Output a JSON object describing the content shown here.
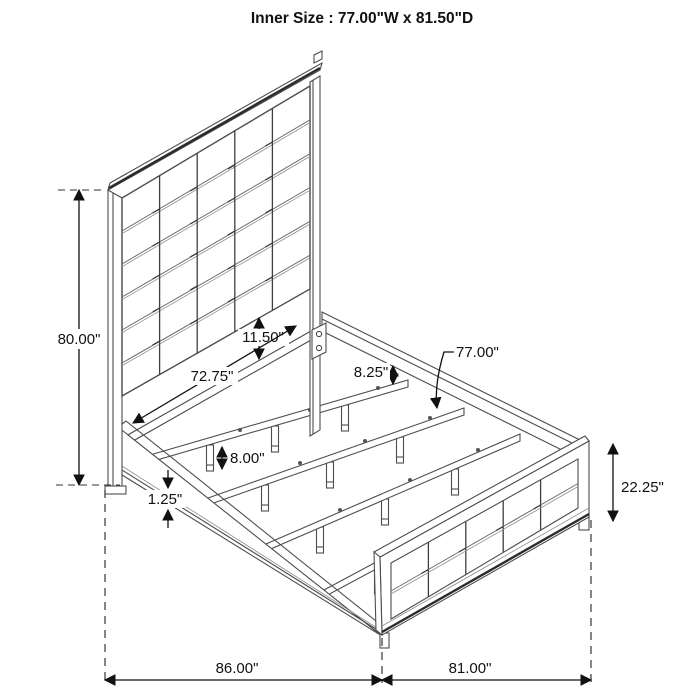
{
  "title": "Inner Size : 77.00\"W x 81.50\"D",
  "dimensions": {
    "headboard_height": "80.00\"",
    "panel_to_rail_gap": "11.50\"",
    "inner_width": "72.75\"",
    "rail_to_slat": "8.25\"",
    "slat_length": "77.00\"",
    "slat_leg_height": "8.00\"",
    "base_trim": "1.25\"",
    "footboard_height": "22.25\"",
    "overall_width": "86.00\"",
    "overall_depth": "81.00\""
  },
  "colors": {
    "line": "#4d4d4d",
    "dimension": "#111111",
    "background": "#ffffff"
  }
}
